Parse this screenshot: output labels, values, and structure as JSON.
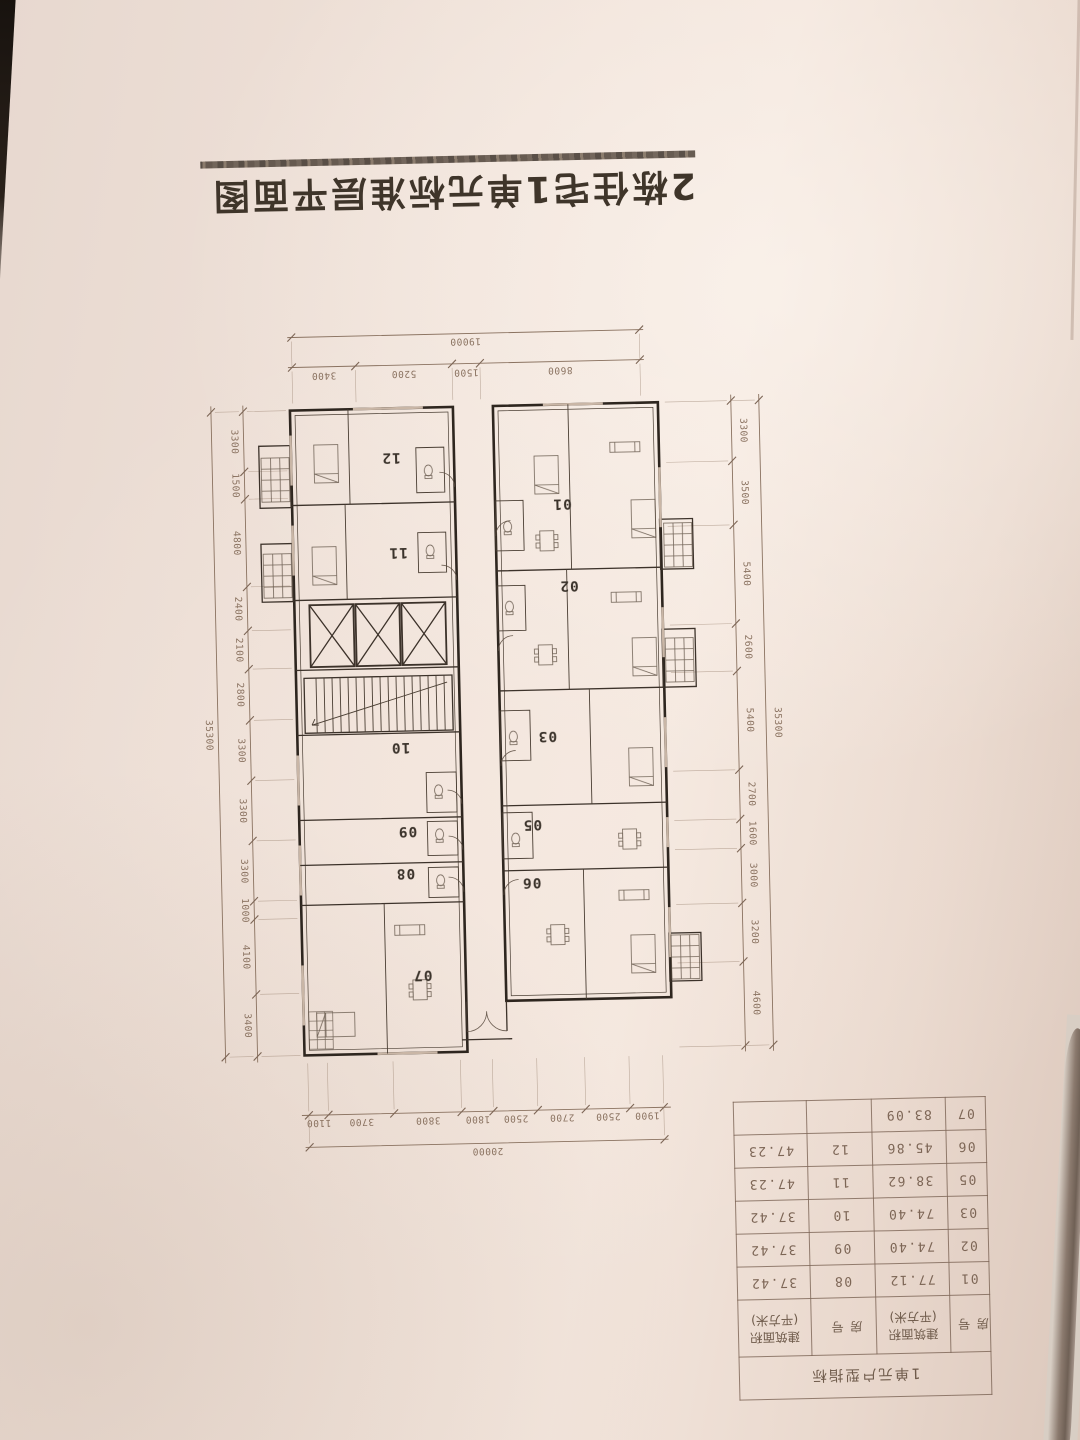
{
  "orientation": "page photographed rotated 180 degrees",
  "title": "2栋住宅1单元标准层平面图",
  "plan": {
    "unit_labels": [
      "01",
      "02",
      "03",
      "05",
      "06",
      "07",
      "08",
      "09",
      "10",
      "11",
      "12"
    ],
    "dims": {
      "top_overall": "20000",
      "top_segments": [
        "1900",
        "2500",
        "2700",
        "2500",
        "1800",
        "3800",
        "3700",
        "1100"
      ],
      "bottom_overall": "19000",
      "bottom_segments": [
        "8600",
        "1500",
        "5200",
        "3400"
      ],
      "left_overall": "35300",
      "left_segments": [
        "4600",
        "3200",
        "3000",
        "1600",
        "2700",
        "5400",
        "2600",
        "5400",
        "3500",
        "3300"
      ],
      "right_overall": "35300",
      "right_segments": [
        "3400",
        "4100",
        "1000",
        "3300",
        "3300",
        "3300",
        "2800",
        "2100",
        "2400",
        "4800",
        "1500",
        "3300"
      ]
    }
  },
  "table": {
    "title": "1单元户型指标",
    "col_headers": [
      {
        "line1": "房号",
        "line2": ""
      },
      {
        "line1": "建筑面积",
        "line2": "(平方米)"
      },
      {
        "line1": "房号",
        "line2": ""
      },
      {
        "line1": "建筑面积",
        "line2": "(平方米)"
      }
    ],
    "rows": [
      [
        "01",
        "77.12",
        "08",
        "37.42"
      ],
      [
        "02",
        "74.40",
        "09",
        "37.42"
      ],
      [
        "03",
        "74.40",
        "10",
        "37.42"
      ],
      [
        "05",
        "38.62",
        "11",
        "47.23"
      ],
      [
        "06",
        "45.86",
        "12",
        "47.23"
      ],
      [
        "07",
        "83.09",
        "",
        ""
      ]
    ]
  },
  "colors": {
    "paper": "#efe1d8",
    "ink": "#3a3127",
    "ink_faded": "#8a7260",
    "wall": "#2e261f",
    "table_ink": "#7d6656",
    "title_ink": "#3f352a",
    "page_edge": "#8b7a6e",
    "page_under": "#d8cec4",
    "corner_dark": "#17120e"
  }
}
